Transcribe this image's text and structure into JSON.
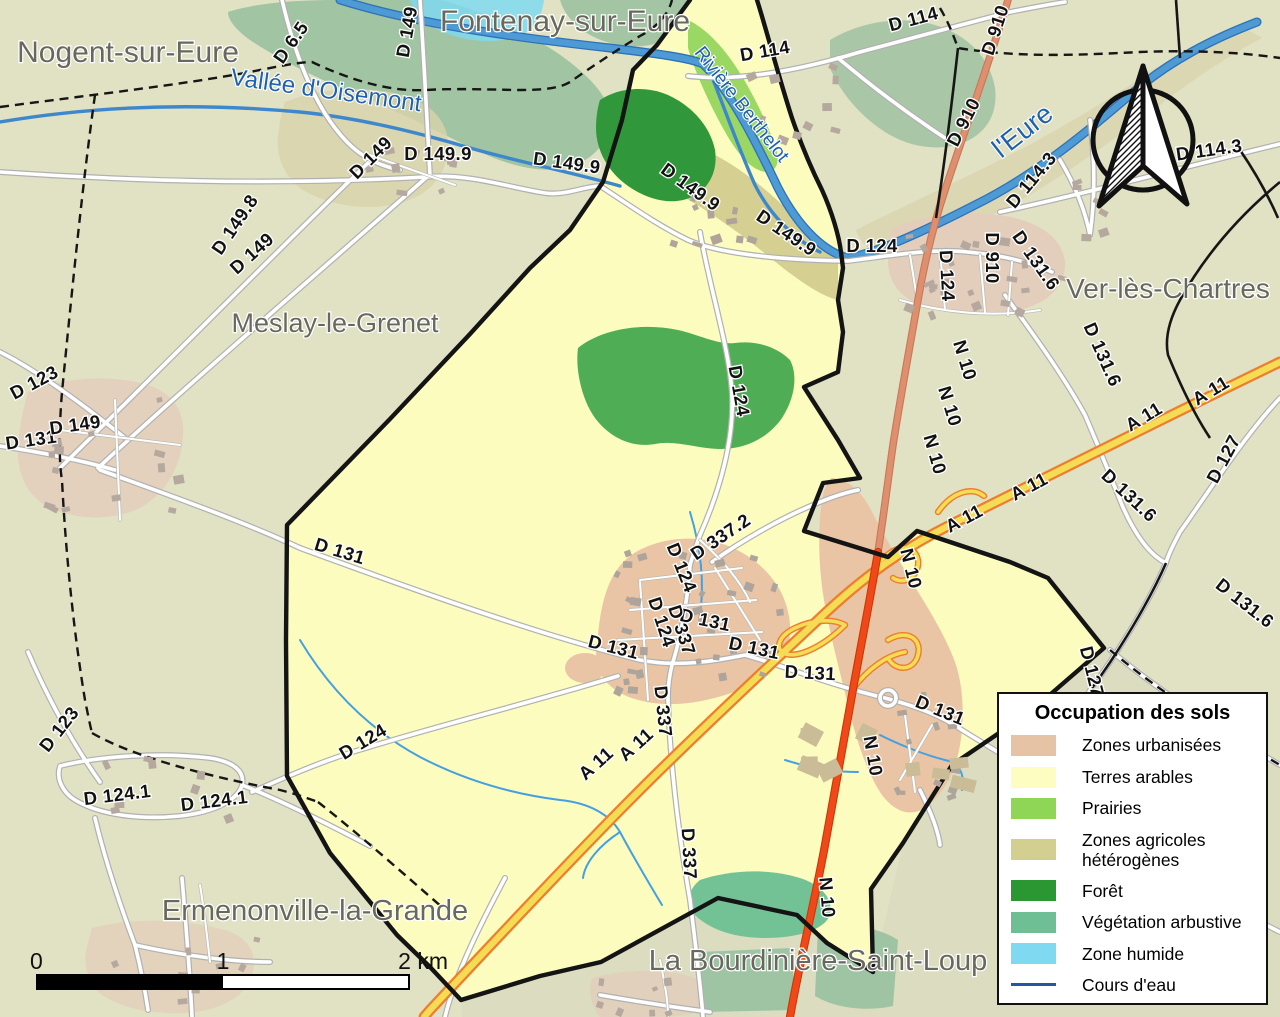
{
  "map_title": "Carte d'occupation des sols de la commune",
  "legend": {
    "title": "Occupation des sols",
    "items": [
      {
        "label": "Zones urbanisées",
        "color": "#E5C3A4",
        "type": "fill"
      },
      {
        "label": "Terres arables",
        "color": "#FDFDC2",
        "type": "fill"
      },
      {
        "label": "Prairies",
        "color": "#8FD556",
        "type": "fill"
      },
      {
        "label": "Zones agricoles hétérogènes",
        "color": "#D3CF90",
        "type": "fill"
      },
      {
        "label": "Forêt",
        "color": "#2A9733",
        "type": "fill"
      },
      {
        "label": "Végétation arbustive",
        "color": "#6FBF95",
        "type": "fill"
      },
      {
        "label": "Zone humide",
        "color": "#7FD9F0",
        "type": "fill"
      },
      {
        "label": "Cours d'eau",
        "color": "#2257A5",
        "type": "line"
      }
    ]
  },
  "scale_bar": {
    "start": "0",
    "mid": "1",
    "end": "2 km"
  },
  "palette": {
    "background_outside": "#E1E1C3",
    "background_southeast": "#DCDCC0",
    "terres_arables": "#FCFCBE",
    "zones_urbanisees": "#EAC5A5",
    "foret": "#30983A",
    "foret_claire": "#4FAE55",
    "prairies": "#9AD763",
    "agricole_heterogene": "#D8D3AB",
    "vegetation_arbustive": "#72C296",
    "zone_humide": "#7FD9F0",
    "riviere": "#4D9AD5",
    "n10": "#F0481A",
    "a11_fill": "#F5DC55",
    "a11_casing": "#EE7D2E",
    "boundary": "#141414"
  },
  "place_labels": [
    {
      "t": "Nogent-sur-Eure",
      "x": 128,
      "y": 62,
      "s": 30
    },
    {
      "t": "Fontenay-sur-Eure",
      "x": 565,
      "y": 31,
      "s": 30
    },
    {
      "t": "Meslay-le-Grenet",
      "x": 335,
      "y": 332,
      "s": 27
    },
    {
      "t": "Ver-lès-Chartres",
      "x": 1168,
      "y": 298,
      "s": 28
    },
    {
      "t": "Ermenonville-la-Grande",
      "x": 315,
      "y": 920,
      "s": 29
    },
    {
      "t": "La Bourdinière-Saint-Loup",
      "x": 818,
      "y": 970,
      "s": 29
    }
  ],
  "water_labels": [
    {
      "t": "Vallée d'Oisemont",
      "x": 325,
      "y": 98,
      "r": 8,
      "s": 24
    },
    {
      "t": "Rivière Berthelot",
      "x": 737,
      "y": 108,
      "r": 52,
      "s": 19
    },
    {
      "t": "l'Eure",
      "x": 1028,
      "y": 138,
      "r": -38,
      "s": 27
    }
  ],
  "road_labels": [
    {
      "t": "D 6.5",
      "x": 296,
      "y": 46,
      "r": -55
    },
    {
      "t": "D 149",
      "x": 413,
      "y": 33,
      "r": -80
    },
    {
      "t": "D 114",
      "x": 766,
      "y": 57,
      "r": -10
    },
    {
      "t": "D 114",
      "x": 915,
      "y": 25,
      "r": -15
    },
    {
      "t": "D 910",
      "x": 1001,
      "y": 32,
      "r": -72
    },
    {
      "t": "D 910",
      "x": 969,
      "y": 125,
      "r": -63
    },
    {
      "t": "D 910",
      "x": 986,
      "y": 258,
      "r": 90
    },
    {
      "t": "D 114.3",
      "x": 1036,
      "y": 184,
      "r": -50
    },
    {
      "t": "D 114.3",
      "x": 1210,
      "y": 156,
      "r": -8
    },
    {
      "t": "D 149",
      "x": 375,
      "y": 162,
      "r": -45
    },
    {
      "t": "D 149.9",
      "x": 438,
      "y": 160,
      "r": 0
    },
    {
      "t": "D 149.9",
      "x": 566,
      "y": 169,
      "r": 8
    },
    {
      "t": "D 149.9",
      "x": 687,
      "y": 192,
      "r": 36
    },
    {
      "t": "D 149.9",
      "x": 783,
      "y": 238,
      "r": 34
    },
    {
      "t": "D 124",
      "x": 872,
      "y": 252,
      "r": 0
    },
    {
      "t": "D 124",
      "x": 941,
      "y": 276,
      "r": 87
    },
    {
      "t": "D 131.6",
      "x": 1031,
      "y": 264,
      "r": 55
    },
    {
      "t": "D 131.6",
      "x": 1097,
      "y": 357,
      "r": 66
    },
    {
      "t": "D 131.6",
      "x": 1125,
      "y": 500,
      "r": 43
    },
    {
      "t": "D 131.6",
      "x": 1241,
      "y": 608,
      "r": 38
    },
    {
      "t": "D 127",
      "x": 1229,
      "y": 462,
      "r": -62
    },
    {
      "t": "D 127",
      "x": 1086,
      "y": 673,
      "r": 76
    },
    {
      "t": "D 149.8",
      "x": 240,
      "y": 228,
      "r": -56
    },
    {
      "t": "D 149",
      "x": 256,
      "y": 258,
      "r": -42
    },
    {
      "t": "D 123",
      "x": 37,
      "y": 388,
      "r": -28
    },
    {
      "t": "D 131",
      "x": 32,
      "y": 446,
      "r": -8
    },
    {
      "t": "D 149",
      "x": 76,
      "y": 431,
      "r": -8
    },
    {
      "t": "D 123",
      "x": 64,
      "y": 733,
      "r": -52
    },
    {
      "t": "D 124.1",
      "x": 118,
      "y": 801,
      "r": -7
    },
    {
      "t": "D 124.1",
      "x": 215,
      "y": 807,
      "r": -7
    },
    {
      "t": "D 131",
      "x": 338,
      "y": 557,
      "r": 17
    },
    {
      "t": "D 124",
      "x": 366,
      "y": 747,
      "r": -31
    },
    {
      "t": "D 124",
      "x": 733,
      "y": 392,
      "r": 80
    },
    {
      "t": "D 124",
      "x": 676,
      "y": 570,
      "r": 68
    },
    {
      "t": "D 124",
      "x": 656,
      "y": 624,
      "r": 72
    },
    {
      "t": "D 337.2",
      "x": 724,
      "y": 542,
      "r": -34
    },
    {
      "t": "D 131",
      "x": 612,
      "y": 653,
      "r": 14
    },
    {
      "t": "D 131",
      "x": 704,
      "y": 626,
      "r": 12
    },
    {
      "t": "D 131",
      "x": 753,
      "y": 654,
      "r": 12
    },
    {
      "t": "D 131",
      "x": 810,
      "y": 679,
      "r": 3
    },
    {
      "t": "D 131",
      "x": 938,
      "y": 716,
      "r": 22
    },
    {
      "t": "D 337",
      "x": 676,
      "y": 632,
      "r": 72
    },
    {
      "t": "D 337",
      "x": 657,
      "y": 712,
      "r": 84
    },
    {
      "t": "D 337",
      "x": 683,
      "y": 854,
      "r": 87
    },
    {
      "t": "N 10",
      "x": 959,
      "y": 362,
      "r": 73
    },
    {
      "t": "N 10",
      "x": 944,
      "y": 408,
      "r": 73
    },
    {
      "t": "N 10",
      "x": 929,
      "y": 456,
      "r": 74
    },
    {
      "t": "N 10",
      "x": 905,
      "y": 570,
      "r": 76
    },
    {
      "t": "N 10",
      "x": 867,
      "y": 757,
      "r": 80
    },
    {
      "t": "N 10",
      "x": 821,
      "y": 898,
      "r": 85
    },
    {
      "t": "A 11",
      "x": 1214,
      "y": 396,
      "r": -31
    },
    {
      "t": "A 11",
      "x": 1147,
      "y": 422,
      "r": -31
    },
    {
      "t": "A 11",
      "x": 1032,
      "y": 492,
      "r": -28
    },
    {
      "t": "A 11",
      "x": 967,
      "y": 524,
      "r": -28
    },
    {
      "t": "A 11",
      "x": 640,
      "y": 749,
      "r": -42
    },
    {
      "t": "A 11",
      "x": 600,
      "y": 768,
      "r": -42
    }
  ]
}
